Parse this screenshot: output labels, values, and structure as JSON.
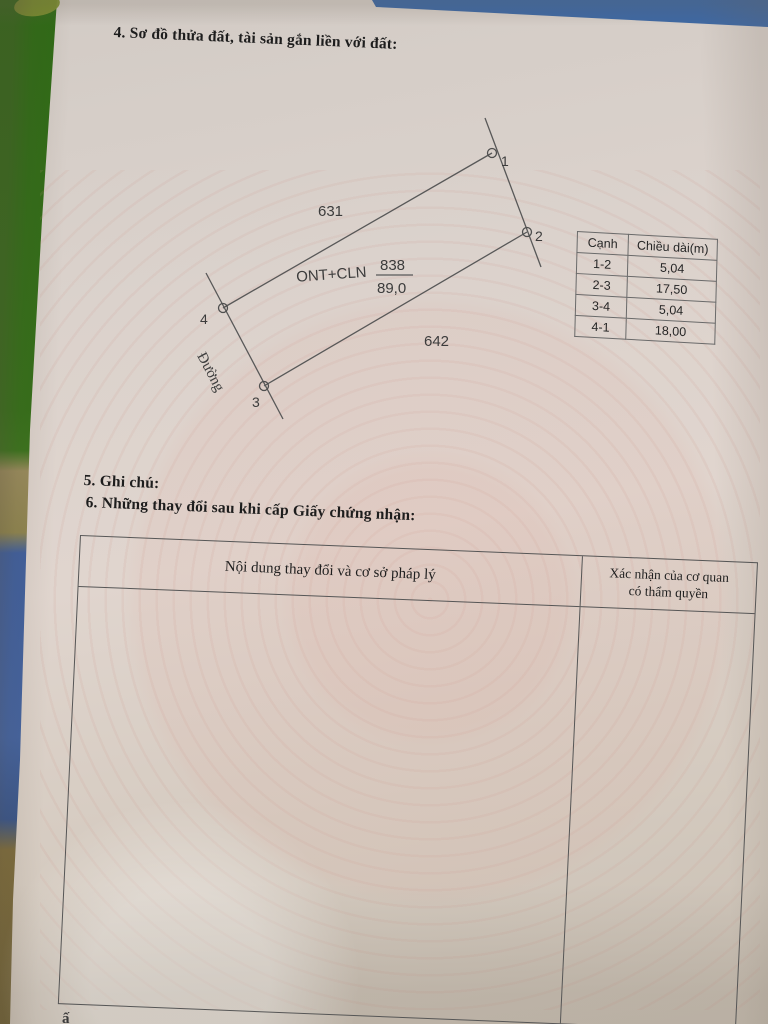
{
  "document": {
    "section4_title": "4. Sơ đồ thửa đất, tài sản gắn liền với đất:",
    "section5_title": "5. Ghi chú:",
    "section6_title": "6. Những thay đổi sau khi cấp Giấy chứng nhận:",
    "bottom_partial_text": "ấ"
  },
  "diagram": {
    "parcel_number": "838",
    "area_m2": "89,0",
    "land_use_code": "ONT+CLN",
    "adjacent_parcel_top": "631",
    "adjacent_parcel_bottom": "642",
    "road_label": "Đường",
    "vertex_labels": [
      "1",
      "2",
      "3",
      "4"
    ]
  },
  "edge_table": {
    "headers": [
      "Cạnh",
      "Chiều dài(m)"
    ],
    "rows": [
      [
        "1-2",
        "5,04"
      ],
      [
        "2-3",
        "17,50"
      ],
      [
        "3-4",
        "5,04"
      ],
      [
        "4-1",
        "18,00"
      ]
    ]
  },
  "changes_table": {
    "col1_header": "Nội dung thay đổi và cơ sở pháp lý",
    "col2_header_line1": "Xác nhận của cơ quan",
    "col2_header_line2": "có thẩm quyền"
  },
  "colors": {
    "paper": "#ddd3cc",
    "watermark_pink": "#d6a096",
    "ink": "#1d1d1d",
    "table_line": "#565656",
    "background_green": "#2e6a15",
    "background_blue_top": "#3e68a3",
    "background_blue_left": "#3f5f9e",
    "background_tan": "#998b5c",
    "background_brown": "#7c6b3d"
  }
}
